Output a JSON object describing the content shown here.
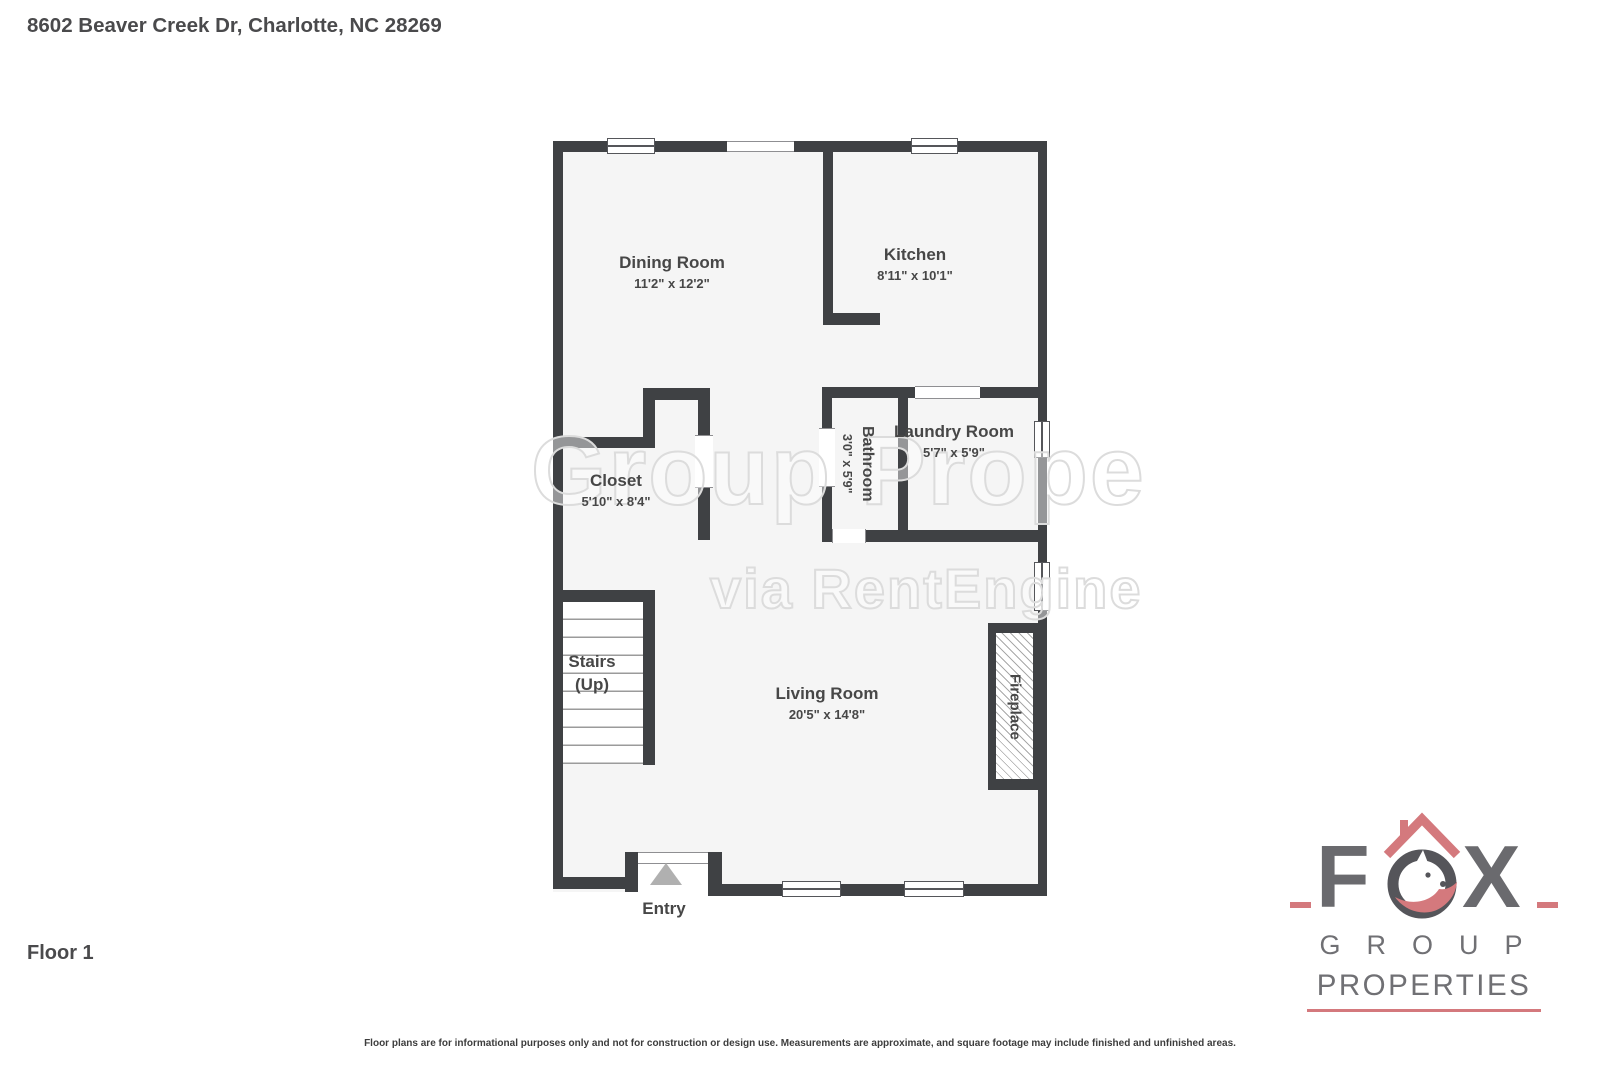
{
  "page": {
    "title": "8602 Beaver Creek Dr, Charlotte, NC 28269",
    "floor_label": "Floor 1",
    "disclaimer": "Floor plans are for informational purposes only and not for construction or design use. Measurements are approximate, and square footage may include finished and unfinished areas."
  },
  "watermark": {
    "line1": "Group Prope",
    "line2": "via RentEngine"
  },
  "rooms": {
    "dining": {
      "name": "Dining Room",
      "dims": "11'2\" x 12'2\""
    },
    "kitchen": {
      "name": "Kitchen",
      "dims": "8'11\" x 10'1\""
    },
    "closet": {
      "name": "Closet",
      "dims": "5'10\" x 8'4\""
    },
    "bathroom": {
      "name": "Bathroom",
      "dims": "3'0\" x 5'9\""
    },
    "laundry": {
      "name": "Laundry Room",
      "dims": "5'7\" x 5'9\""
    },
    "stairs": {
      "name": "Stairs",
      "sub": "(Up)"
    },
    "living": {
      "name": "Living Room",
      "dims": "20'5\" x 14'8\""
    },
    "fireplace": {
      "name": "Fireplace"
    },
    "entry": {
      "name": "Entry"
    }
  },
  "logo": {
    "letter_f": "F",
    "letter_x": "X",
    "group": "GROUP",
    "properties": "PROPERTIES",
    "text_color": "#6a6a6e",
    "accent_color": "#d4797d"
  },
  "colors": {
    "wall": "#3f4144",
    "floor": "#f5f5f5",
    "label_text": "#474747",
    "entry_arrow": "#b0b0b0"
  }
}
